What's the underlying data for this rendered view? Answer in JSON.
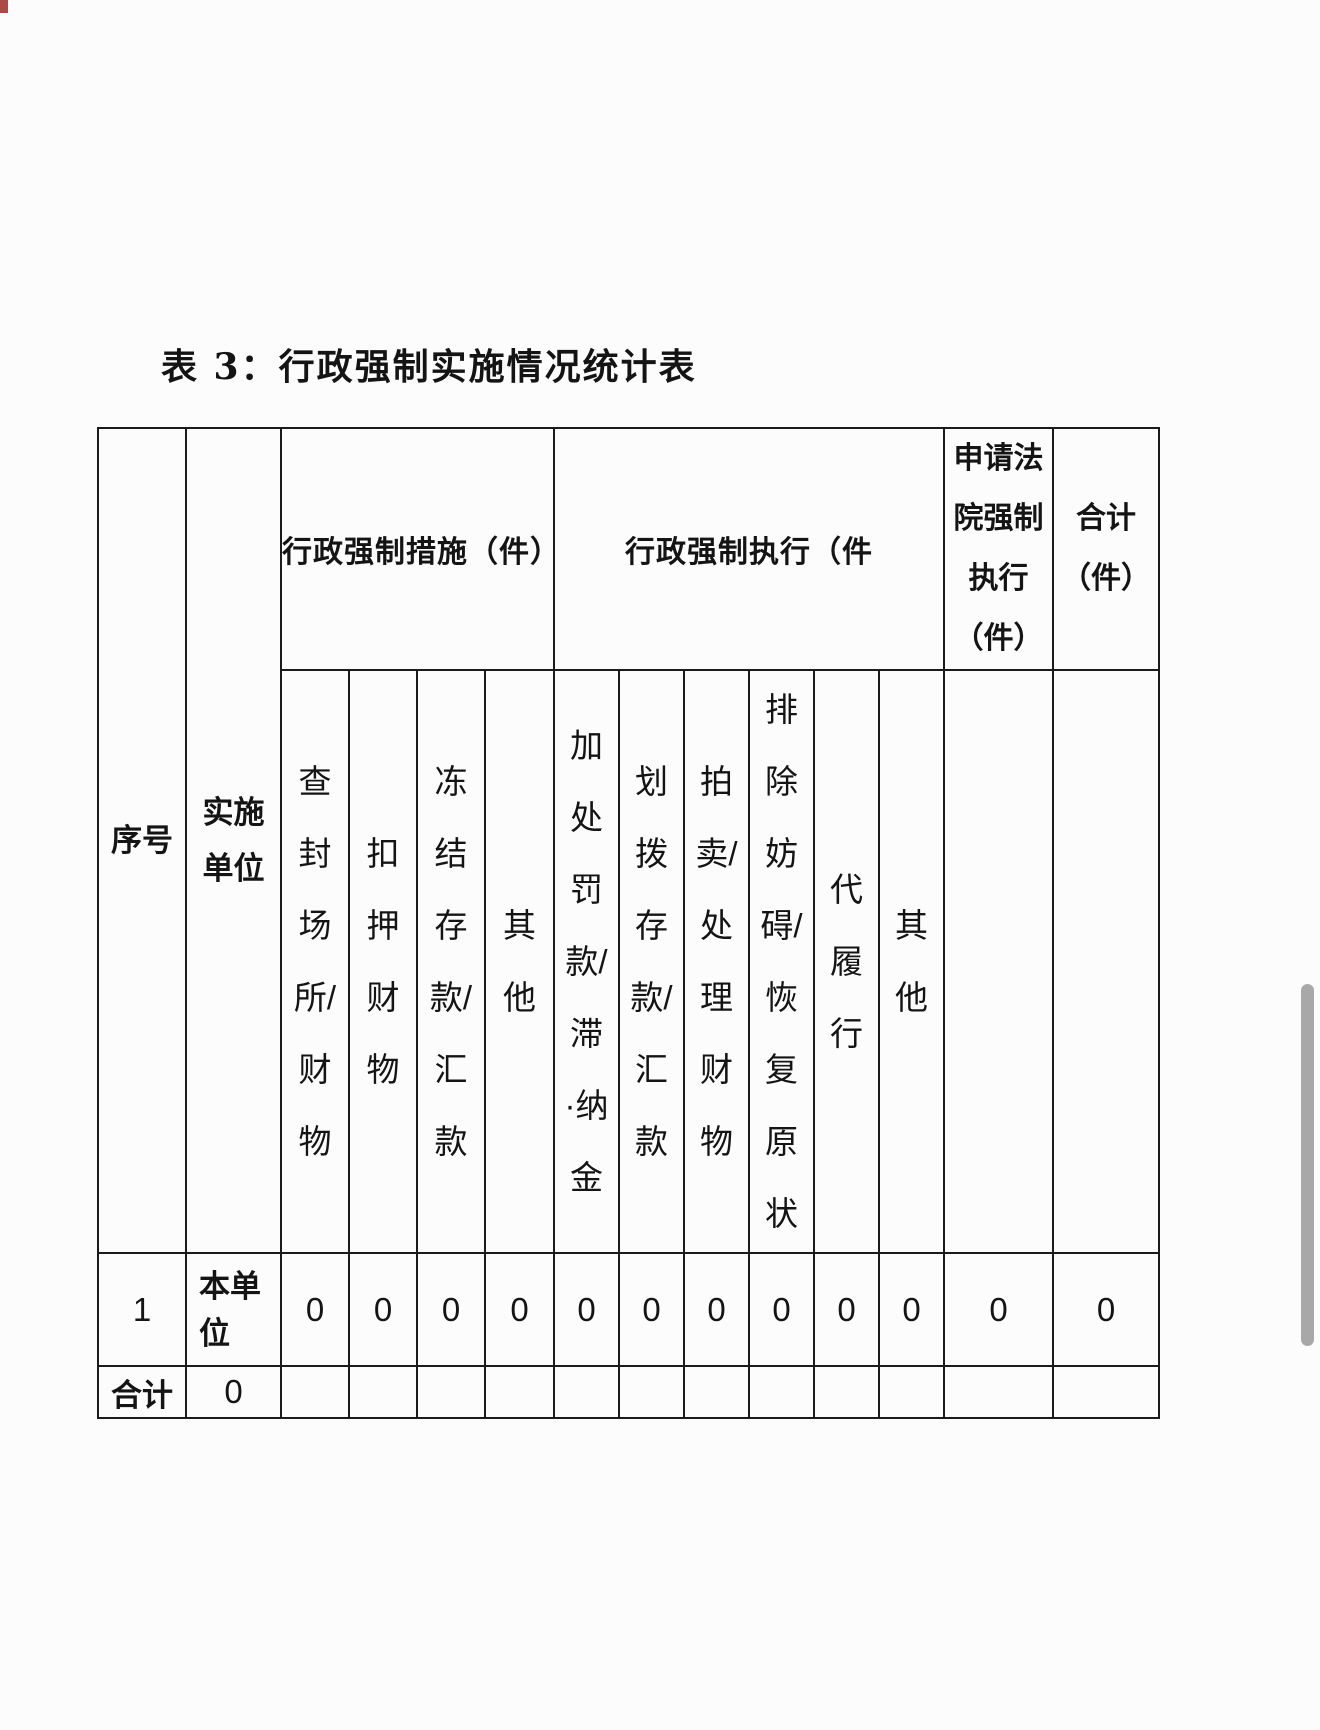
{
  "title": "表 3：行政强制实施情况统计表",
  "colors": {
    "page_bg": "#fcfcfc",
    "table_border": "#1b1b1b",
    "scrollbar": "#a8a8a8"
  },
  "table": {
    "corner_headers": {
      "serial": "序号",
      "unit": "实施\n单位"
    },
    "groups": {
      "measures": "行政强制措施（件）",
      "enforcement": "行政强制执行（件",
      "court": "申请法\n院强制\n执行\n（件）",
      "total": "合计\n（件）"
    },
    "sub_headers": [
      "查\n封\n场\n所/\n财\n物",
      "扣\n押\n财\n物",
      "冻\n结\n存\n款/\n汇\n款",
      "其\n他",
      "加\n处\n罚\n款/\n滞\n·纳\n金",
      "划\n拨\n存\n款/\n汇\n款",
      "拍\n卖/\n处\n理\n财\n物",
      "排\n除\n妨\n碍/\n恢\n复\n原\n状",
      "代\n履\n行",
      "其\n他"
    ],
    "rows": [
      {
        "serial": "1",
        "unit": "本单\n位",
        "values": [
          "0",
          "0",
          "0",
          "0",
          "0",
          "0",
          "0",
          "0",
          "0",
          "0"
        ],
        "court": "0",
        "total": "0"
      }
    ],
    "footer": {
      "label": "合计",
      "unit_total": "0"
    }
  }
}
